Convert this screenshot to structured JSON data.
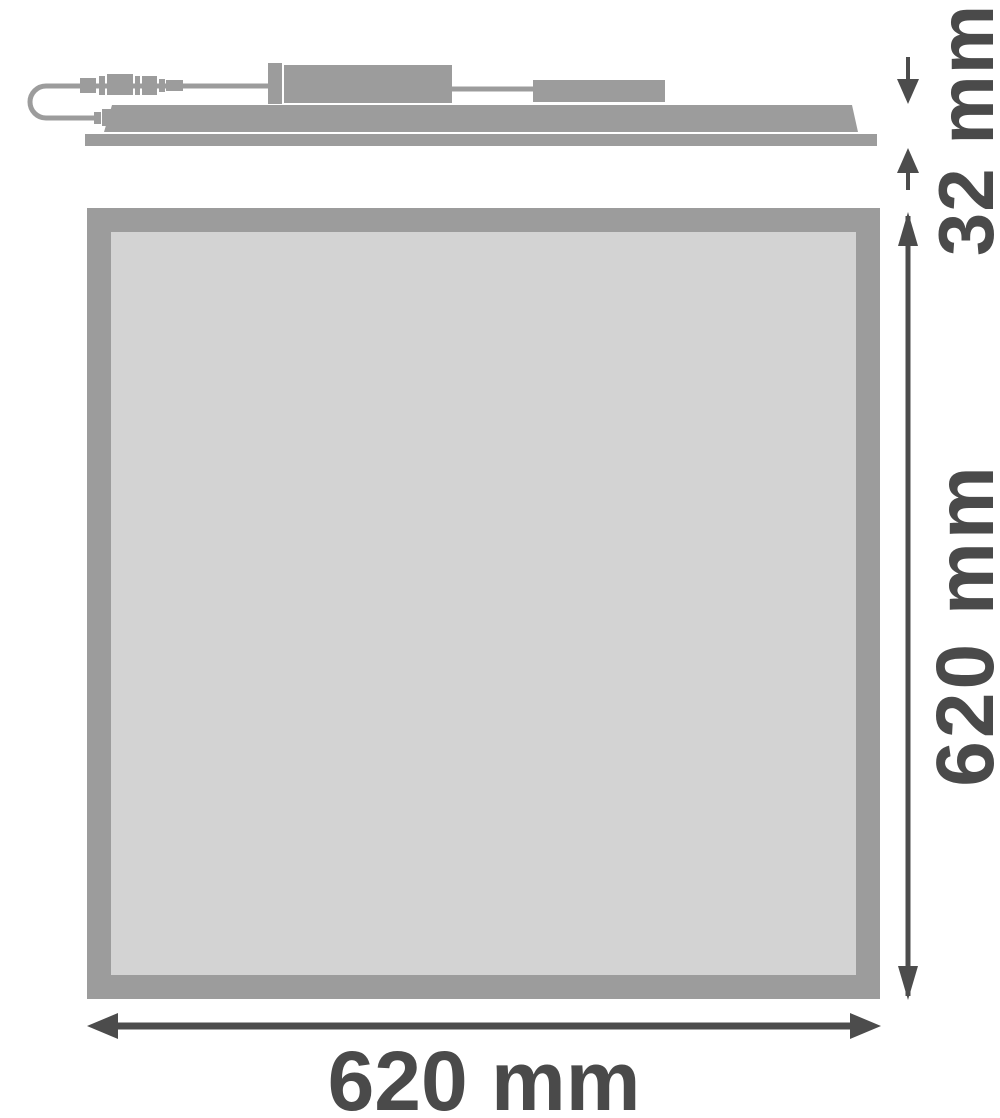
{
  "diagram": {
    "dimensions": {
      "thickness_label": "32 mm",
      "height_label": "620 mm",
      "width_label": "620 mm"
    },
    "icons": {
      "thickness_arrows": [
        "arrow-down-icon",
        "arrow-up-icon"
      ],
      "height_arrows": [
        "arrow-up-icon",
        "arrow-down-icon"
      ],
      "width_arrows": [
        "arrow-left-icon",
        "arrow-right-icon"
      ]
    },
    "colors": {
      "shape_gray": "#9c9c9c",
      "panel_face": "#d3d3d3",
      "dimension_dark": "#4a4a4a",
      "background": "#ffffff"
    }
  }
}
